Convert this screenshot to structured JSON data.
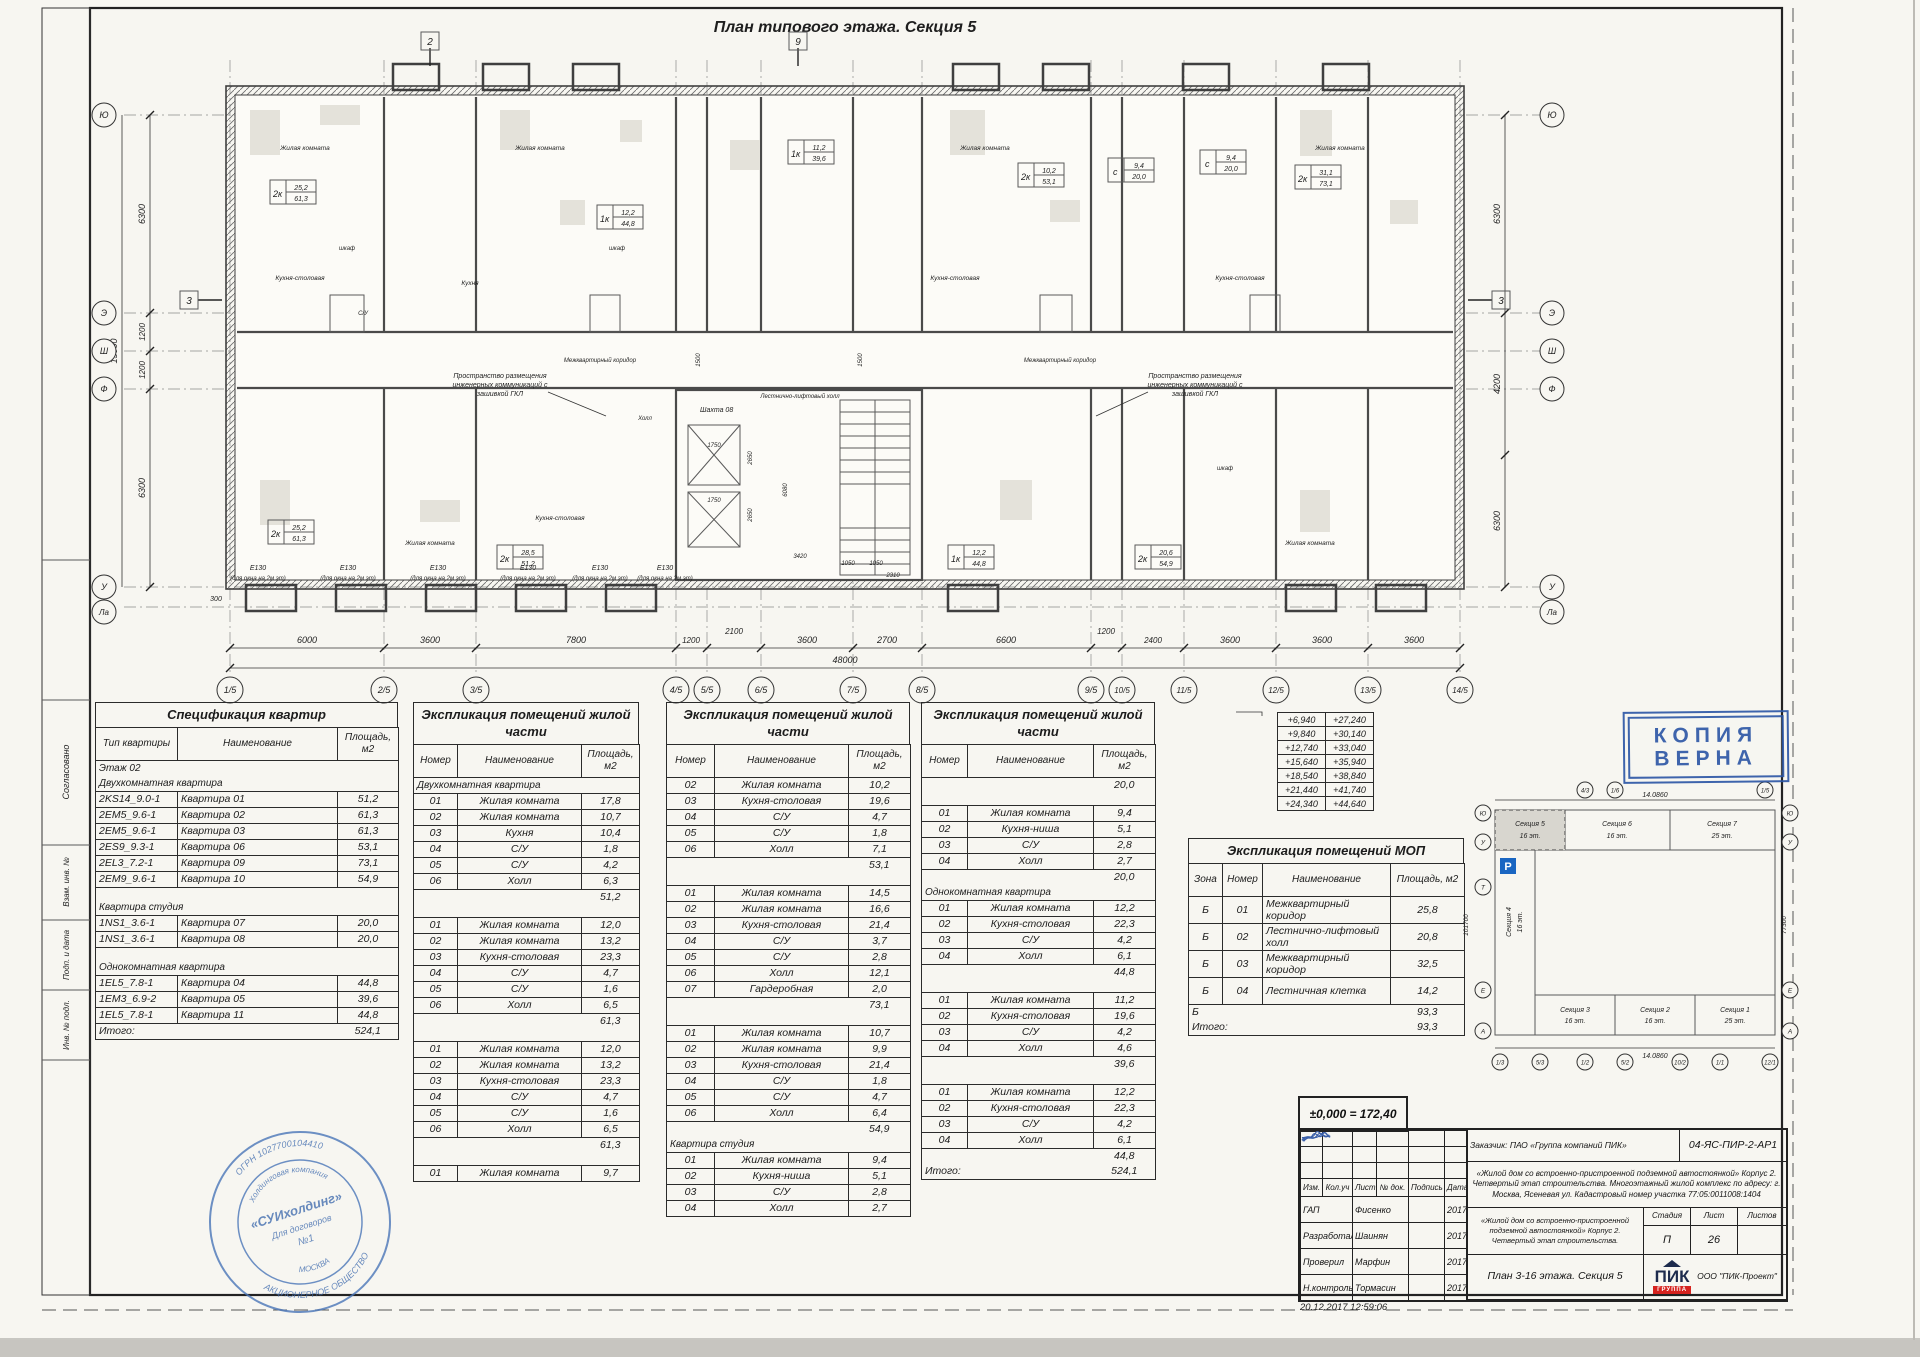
{
  "sheet": {
    "frame_labels": [
      "Согласовано",
      "Взам. инв. №",
      "Подп. и дата",
      "Инв. № подл."
    ]
  },
  "plan": {
    "title": "План типового этажа. Секция 5",
    "grid_cols": [
      "1/5",
      "2/5",
      "3/5",
      "4/5",
      "5/5",
      "6/5",
      "7/5",
      "8/5",
      "9/5",
      "10/5",
      "11/5",
      "12/5",
      "13/5",
      "14/5"
    ],
    "grid_rows": [
      "Ю",
      "Э",
      "Ш",
      "Ф",
      "У",
      "Ла"
    ],
    "dims_bottom": [
      "6000",
      "3600",
      "7800",
      "1200",
      "2100",
      "3600",
      "2700",
      "6600",
      "1200",
      "2400",
      "3600",
      "3600",
      "3600"
    ],
    "dim_total": "48000",
    "dims_left": [
      "6300",
      "1200",
      "1200",
      "6300"
    ],
    "dim_left_total": "15000",
    "dims_right": [
      "6300",
      "4200",
      "6300"
    ],
    "dim_offset": "300",
    "marks": {
      "m2": "2",
      "m9": "9",
      "m3": "3"
    },
    "core": {
      "shaft": "Шахта 08",
      "d1": "1750",
      "d2": "2650",
      "d3": "1750",
      "d4": "2650",
      "d5": "3420",
      "d6": "1050",
      "d7": "1050",
      "d8": "2310",
      "d9": "6080",
      "d10": "1500",
      "d11": "1500"
    },
    "note_lines": [
      "Пространство размещения",
      "инженерных коммуникаций с",
      "зашивкой ГКЛ"
    ],
    "corridor_label": "Межквартирный коридор",
    "stair_label": "Лестнично-лифтовый холл",
    "e_mark": "Е130",
    "window_note": "(для окна на 2м эт)",
    "rooms": [
      "Жилая комната",
      "Кухня-столовая",
      "Кухня",
      "шкаф",
      "Холл",
      "С/У"
    ],
    "tags": [
      {
        "t": "2к",
        "a": "25,2",
        "b": "61,3"
      },
      {
        "t": "1к",
        "a": "12,2",
        "b": "44,8"
      },
      {
        "t": "1к",
        "a": "11,2",
        "b": "39,6"
      },
      {
        "t": "2к",
        "a": "10,2",
        "b": "53,1"
      },
      {
        "t": "с",
        "a": "9,4",
        "b": "20,0"
      },
      {
        "t": "с",
        "a": "9,4",
        "b": "20,0"
      },
      {
        "t": "2к",
        "a": "31,1",
        "b": "73,1"
      },
      {
        "t": "2к",
        "a": "25,2",
        "b": "61,3"
      },
      {
        "t": "2к",
        "a": "28,5",
        "b": "51,2"
      },
      {
        "t": "1к",
        "a": "12,2",
        "b": "44,8"
      },
      {
        "t": "2к",
        "a": "20,6",
        "b": "54,9"
      }
    ]
  },
  "spec": {
    "title": "Спецификация квартир",
    "rows": [
      {
        "t": "h",
        "c": [
          "Тип квартиры",
          "Наименование",
          "Площадь, м2"
        ]
      },
      {
        "t": "lbl",
        "c": [
          "Этаж 02"
        ]
      },
      {
        "t": "lbl",
        "c": [
          "Двухкомнатная квартира"
        ]
      },
      {
        "c": [
          "2KS14_9.0-1",
          "Квартира 01",
          "51,2"
        ]
      },
      {
        "c": [
          "2EM5_9.6-1",
          "Квартира 02",
          "61,3"
        ]
      },
      {
        "c": [
          "2EM5_9.6-1",
          "Квартира 03",
          "61,3"
        ]
      },
      {
        "c": [
          "2ES9_9.3-1",
          "Квартира 06",
          "53,1"
        ]
      },
      {
        "c": [
          "2EL3_7.2-1",
          "Квартира 09",
          "73,1"
        ]
      },
      {
        "c": [
          "2EM9_9.6-1",
          "Квартира 10",
          "54,9"
        ]
      },
      {
        "t": "gap"
      },
      {
        "t": "lbl",
        "c": [
          "Квартира студия"
        ]
      },
      {
        "c": [
          "1NS1_3.6-1",
          "Квартира 07",
          "20,0"
        ]
      },
      {
        "c": [
          "1NS1_3.6-1",
          "Квартира 08",
          "20,0"
        ]
      },
      {
        "t": "gap"
      },
      {
        "t": "lbl",
        "c": [
          "Однокомнатная квартира"
        ]
      },
      {
        "c": [
          "1EL5_7.8-1",
          "Квартира 04",
          "44,8"
        ]
      },
      {
        "c": [
          "1EM3_6.9-2",
          "Квартира 05",
          "39,6"
        ]
      },
      {
        "c": [
          "1EL5_7.8-1",
          "Квартира 11",
          "44,8"
        ]
      },
      {
        "t": "tot",
        "c": [
          "Итого:",
          "524,1"
        ]
      }
    ]
  },
  "expl1": {
    "title": "Экспликация помещений жилой части",
    "rows": [
      {
        "t": "h",
        "c": [
          "Номер",
          "Наименование",
          "Площадь, м2"
        ]
      },
      {
        "t": "lbl",
        "c": [
          "Двухкомнатная квартира"
        ]
      },
      {
        "c": [
          "01",
          "Жилая комната",
          "17,8"
        ]
      },
      {
        "c": [
          "02",
          "Жилая комната",
          "10,7"
        ]
      },
      {
        "c": [
          "03",
          "Кухня",
          "10,4"
        ]
      },
      {
        "c": [
          "04",
          "С/У",
          "1,8"
        ]
      },
      {
        "c": [
          "05",
          "С/У",
          "4,2"
        ]
      },
      {
        "c": [
          "06",
          "Холл",
          "6,3"
        ]
      },
      {
        "t": "sub",
        "c": [
          "51,2"
        ]
      },
      {
        "t": "gap"
      },
      {
        "c": [
          "01",
          "Жилая комната",
          "12,0"
        ]
      },
      {
        "c": [
          "02",
          "Жилая комната",
          "13,2"
        ]
      },
      {
        "c": [
          "03",
          "Кухня-столовая",
          "23,3"
        ]
      },
      {
        "c": [
          "04",
          "С/У",
          "4,7"
        ]
      },
      {
        "c": [
          "05",
          "С/У",
          "1,6"
        ]
      },
      {
        "c": [
          "06",
          "Холл",
          "6,5"
        ]
      },
      {
        "t": "sub",
        "c": [
          "61,3"
        ]
      },
      {
        "t": "gap"
      },
      {
        "c": [
          "01",
          "Жилая комната",
          "12,0"
        ]
      },
      {
        "c": [
          "02",
          "Жилая комната",
          "13,2"
        ]
      },
      {
        "c": [
          "03",
          "Кухня-столовая",
          "23,3"
        ]
      },
      {
        "c": [
          "04",
          "С/У",
          "4,7"
        ]
      },
      {
        "c": [
          "05",
          "С/У",
          "1,6"
        ]
      },
      {
        "c": [
          "06",
          "Холл",
          "6,5"
        ]
      },
      {
        "t": "sub",
        "c": [
          "61,3"
        ]
      },
      {
        "t": "gap"
      },
      {
        "c": [
          "01",
          "Жилая комната",
          "9,7"
        ]
      }
    ]
  },
  "expl2": {
    "title": "Экспликация помещений жилой части",
    "rows": [
      {
        "t": "h",
        "c": [
          "Номер",
          "Наименование",
          "Площадь, м2"
        ]
      },
      {
        "c": [
          "02",
          "Жилая комната",
          "10,2"
        ]
      },
      {
        "c": [
          "03",
          "Кухня-столовая",
          "19,6"
        ]
      },
      {
        "c": [
          "04",
          "С/У",
          "4,7"
        ]
      },
      {
        "c": [
          "05",
          "С/У",
          "1,8"
        ]
      },
      {
        "c": [
          "06",
          "Холл",
          "7,1"
        ]
      },
      {
        "t": "sub",
        "c": [
          "53,1"
        ]
      },
      {
        "t": "gap"
      },
      {
        "c": [
          "01",
          "Жилая комната",
          "14,5"
        ]
      },
      {
        "c": [
          "02",
          "Жилая комната",
          "16,6"
        ]
      },
      {
        "c": [
          "03",
          "Кухня-столовая",
          "21,4"
        ]
      },
      {
        "c": [
          "04",
          "С/У",
          "3,7"
        ]
      },
      {
        "c": [
          "05",
          "С/У",
          "2,8"
        ]
      },
      {
        "c": [
          "06",
          "Холл",
          "12,1"
        ]
      },
      {
        "c": [
          "07",
          "Гардеробная",
          "2,0"
        ]
      },
      {
        "t": "sub",
        "c": [
          "73,1"
        ]
      },
      {
        "t": "gap"
      },
      {
        "c": [
          "01",
          "Жилая комната",
          "10,7"
        ]
      },
      {
        "c": [
          "02",
          "Жилая комната",
          "9,9"
        ]
      },
      {
        "c": [
          "03",
          "Кухня-столовая",
          "21,4"
        ]
      },
      {
        "c": [
          "04",
          "С/У",
          "1,8"
        ]
      },
      {
        "c": [
          "05",
          "С/У",
          "4,7"
        ]
      },
      {
        "c": [
          "06",
          "Холл",
          "6,4"
        ]
      },
      {
        "t": "sub",
        "c": [
          "54,9"
        ]
      },
      {
        "t": "lbl",
        "c": [
          "Квартира студия"
        ]
      },
      {
        "c": [
          "01",
          "Жилая комната",
          "9,4"
        ]
      },
      {
        "c": [
          "02",
          "Кухня-ниша",
          "5,1"
        ]
      },
      {
        "c": [
          "03",
          "С/У",
          "2,8"
        ]
      },
      {
        "c": [
          "04",
          "Холл",
          "2,7"
        ]
      }
    ]
  },
  "expl3": {
    "title": "Экспликация помещений жилой части",
    "rows": [
      {
        "t": "h",
        "c": [
          "Номер",
          "Наименование",
          "Площадь, м2"
        ]
      },
      {
        "t": "sub",
        "c": [
          "20,0"
        ]
      },
      {
        "t": "gap"
      },
      {
        "c": [
          "01",
          "Жилая комната",
          "9,4"
        ]
      },
      {
        "c": [
          "02",
          "Кухня-ниша",
          "5,1"
        ]
      },
      {
        "c": [
          "03",
          "С/У",
          "2,8"
        ]
      },
      {
        "c": [
          "04",
          "Холл",
          "2,7"
        ]
      },
      {
        "t": "sub",
        "c": [
          "20,0"
        ]
      },
      {
        "t": "lbl",
        "c": [
          "Однокомнатная квартира"
        ]
      },
      {
        "c": [
          "01",
          "Жилая комната",
          "12,2"
        ]
      },
      {
        "c": [
          "02",
          "Кухня-столовая",
          "22,3"
        ]
      },
      {
        "c": [
          "03",
          "С/У",
          "4,2"
        ]
      },
      {
        "c": [
          "04",
          "Холл",
          "6,1"
        ]
      },
      {
        "t": "sub",
        "c": [
          "44,8"
        ]
      },
      {
        "t": "gap"
      },
      {
        "c": [
          "01",
          "Жилая комната",
          "11,2"
        ]
      },
      {
        "c": [
          "02",
          "Кухня-столовая",
          "19,6"
        ]
      },
      {
        "c": [
          "03",
          "С/У",
          "4,2"
        ]
      },
      {
        "c": [
          "04",
          "Холл",
          "4,6"
        ]
      },
      {
        "t": "sub",
        "c": [
          "39,6"
        ]
      },
      {
        "t": "gap"
      },
      {
        "c": [
          "01",
          "Жилая комната",
          "12,2"
        ]
      },
      {
        "c": [
          "02",
          "Кухня-столовая",
          "22,3"
        ]
      },
      {
        "c": [
          "03",
          "С/У",
          "4,2"
        ]
      },
      {
        "c": [
          "04",
          "Холл",
          "6,1"
        ]
      },
      {
        "t": "sub",
        "c": [
          "44,8"
        ]
      },
      {
        "t": "tot",
        "c": [
          "Итого:",
          "524,1"
        ]
      }
    ]
  },
  "mop": {
    "title": "Экспликация помещений МОП",
    "rows": [
      {
        "t": "h",
        "c": [
          "Зона",
          "Номер",
          "Наименование",
          "Площадь, м2"
        ]
      },
      {
        "c": [
          "Б",
          "01",
          "Межквартирный коридор",
          "25,8"
        ]
      },
      {
        "c": [
          "Б",
          "02",
          "Лестнично-лифтовый холл",
          "20,8"
        ]
      },
      {
        "c": [
          "Б",
          "03",
          "Межквартирный коридор",
          "32,5"
        ]
      },
      {
        "c": [
          "Б",
          "04",
          "Лестничная клетка",
          "14,2"
        ]
      },
      {
        "t": "tot",
        "c": [
          "Б",
          "93,3"
        ]
      },
      {
        "t": "tot",
        "c": [
          "Итого:",
          "93,3"
        ]
      }
    ]
  },
  "elevations": {
    "rows": [
      {
        "c": [
          "+6,940",
          "+27,240"
        ]
      },
      {
        "c": [
          "+9,840",
          "+30,140"
        ]
      },
      {
        "c": [
          "+12,740",
          "+33,040"
        ]
      },
      {
        "c": [
          "+15,640",
          "+35,940"
        ]
      },
      {
        "c": [
          "+18,540",
          "+38,840"
        ]
      },
      {
        "c": [
          "+21,440",
          "+41,740"
        ]
      },
      {
        "c": [
          "+24,340",
          "+44,640"
        ]
      }
    ]
  },
  "copy_stamp": {
    "l1": "КОПИЯ",
    "l2": "ВЕРНА"
  },
  "key_plan": {
    "sections": [
      {
        "n": "Секция 5",
        "f": "16 эт."
      },
      {
        "n": "Секция 6",
        "f": "16 эт."
      },
      {
        "n": "Секция 7",
        "f": "25 эт."
      },
      {
        "n": "Секция 4",
        "f": "16 эт."
      },
      {
        "n": "Секция 3",
        "f": "16 эт."
      },
      {
        "n": "Секция 2",
        "f": "16 эт."
      },
      {
        "n": "Секция 1",
        "f": "25 эт."
      }
    ],
    "dim_top": "14.0860",
    "dim_bottom": "14.0860",
    "dim_left": "101700",
    "dim_right": "77300",
    "parking": "P",
    "bubbles_left": [
      "Ю",
      "У",
      "Т",
      "Е",
      "А"
    ],
    "bubbles_right": [
      "Ю",
      "У",
      "Е",
      "А"
    ],
    "bubbles_top": [
      "4/3",
      "1/6",
      "1/5"
    ],
    "bubbles_bottom": [
      "1/3",
      "5/3",
      "1/2",
      "5/2",
      "10/2",
      "1/1",
      "12/1"
    ]
  },
  "title_block": {
    "zero_mark": "±0,000 = 172,40",
    "customer": "Заказчик: ПАО «Группа компаний ПИК»",
    "doc_no": "04-ЯС-ПИР-2-АР1",
    "project": "«Жилой дом со встроенно-пристроенной подземной автостоянкой» Корпус 2. Четвертый этап строительства. Многоэтажный жилой комплекс по адресу: г. Москва, Ясеневая ул. Кадастровый номер участка 77:05:0011008:1404",
    "object": "«Жилой дом со встроенно-пристроенной подземной автостоянкой» Корпус 2. Четвертый этап строительства.",
    "stage_h": "Стадия",
    "sheet_h": "Лист",
    "sheets_h": "Листов",
    "stage": "П",
    "sheet": "26",
    "sheets": "",
    "sheet_name": "План 3-16 этажа. Секция 5",
    "logo_text": "ПИК",
    "logo_sub": "ГРУППА",
    "company": "ООО \"ПИК-Проект\"",
    "cols": [
      "Изм.",
      "Кол.уч",
      "Лист",
      "№ док.",
      "Подпись",
      "Дата"
    ],
    "roles": [
      {
        "r": "ГАП",
        "n": "Фисенко",
        "d": "2017"
      },
      {
        "r": "Разработал",
        "n": "Шаинян",
        "d": "2017"
      },
      {
        "r": "Проверил",
        "n": "Марфин",
        "d": "2017"
      },
      {
        "r": "Н.контроль",
        "n": "Тормасин",
        "d": "2017"
      }
    ],
    "timestamp": "20.12.2017 12:59:06"
  },
  "round_stamp": {
    "arc_top": "ОГРН 1027700104410",
    "arc_bottom": "АКЦИОНЕРНОЕ ОБЩЕСТВО",
    "ring_top": "Холдинговая компания",
    "ring_bottom": "МОСКВА",
    "center1": "«СУИхолдинг»",
    "center2": "Для договоров",
    "center3": "№1"
  }
}
